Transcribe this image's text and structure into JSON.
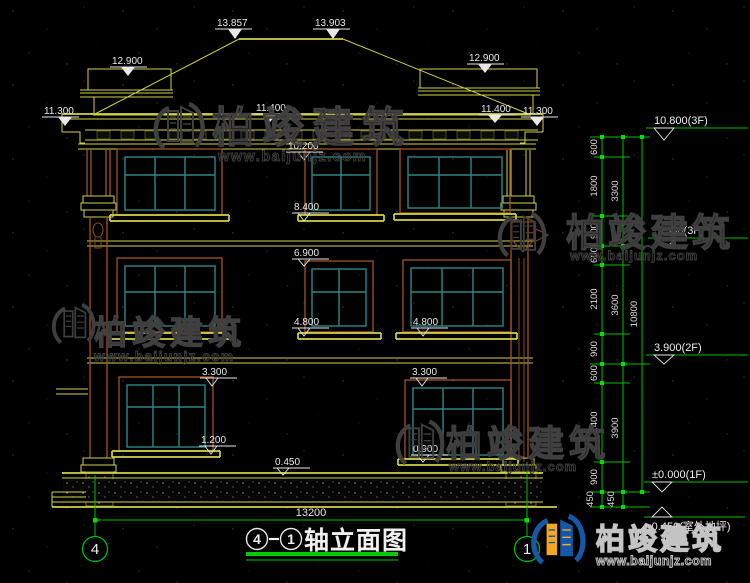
{
  "colors": {
    "background": "#000000",
    "cad_yellow": "#d2d248",
    "cad_green": "#00bf00",
    "frame_brown": "#a35427",
    "frame_teal": "#2f8585",
    "text_white": "#e8e8e8",
    "watermark_gray": "#3f3f3f",
    "logo_blue": "#1558a8",
    "logo_orange": "#f5a623"
  },
  "watermark": {
    "brand": "柏竣建筑",
    "url": "www.baijunjz.com"
  },
  "axes": {
    "left": "4",
    "right": "1"
  },
  "title_block": {
    "axis_from": "4",
    "separator": "-",
    "axis_to": "1",
    "title": "轴立面图",
    "overall_dim": "13200"
  },
  "labels": {
    "top": [
      "13.857",
      "13.903",
      "12.900",
      "12.900",
      "11.300",
      "11.400",
      "11.400",
      "11.300"
    ],
    "wall": [
      "10.200",
      "8.400",
      "6.900",
      "4.800",
      "4.800",
      "3.300",
      "3.300",
      "1.200",
      "0.900",
      "0.450"
    ],
    "right": [
      "10.800(3F)",
      "7.500(3F)",
      "3.900(2F)",
      "±0.000(1F)",
      "-0.450(室外地坪)"
    ],
    "dims_inner": [
      "600",
      "1800",
      "900",
      "600",
      "2100",
      "900",
      "600",
      "2400",
      "900",
      "450"
    ],
    "dims_middle": [
      "3300",
      "3600",
      "3900",
      "450"
    ],
    "dims_outer": [
      "10800"
    ]
  }
}
